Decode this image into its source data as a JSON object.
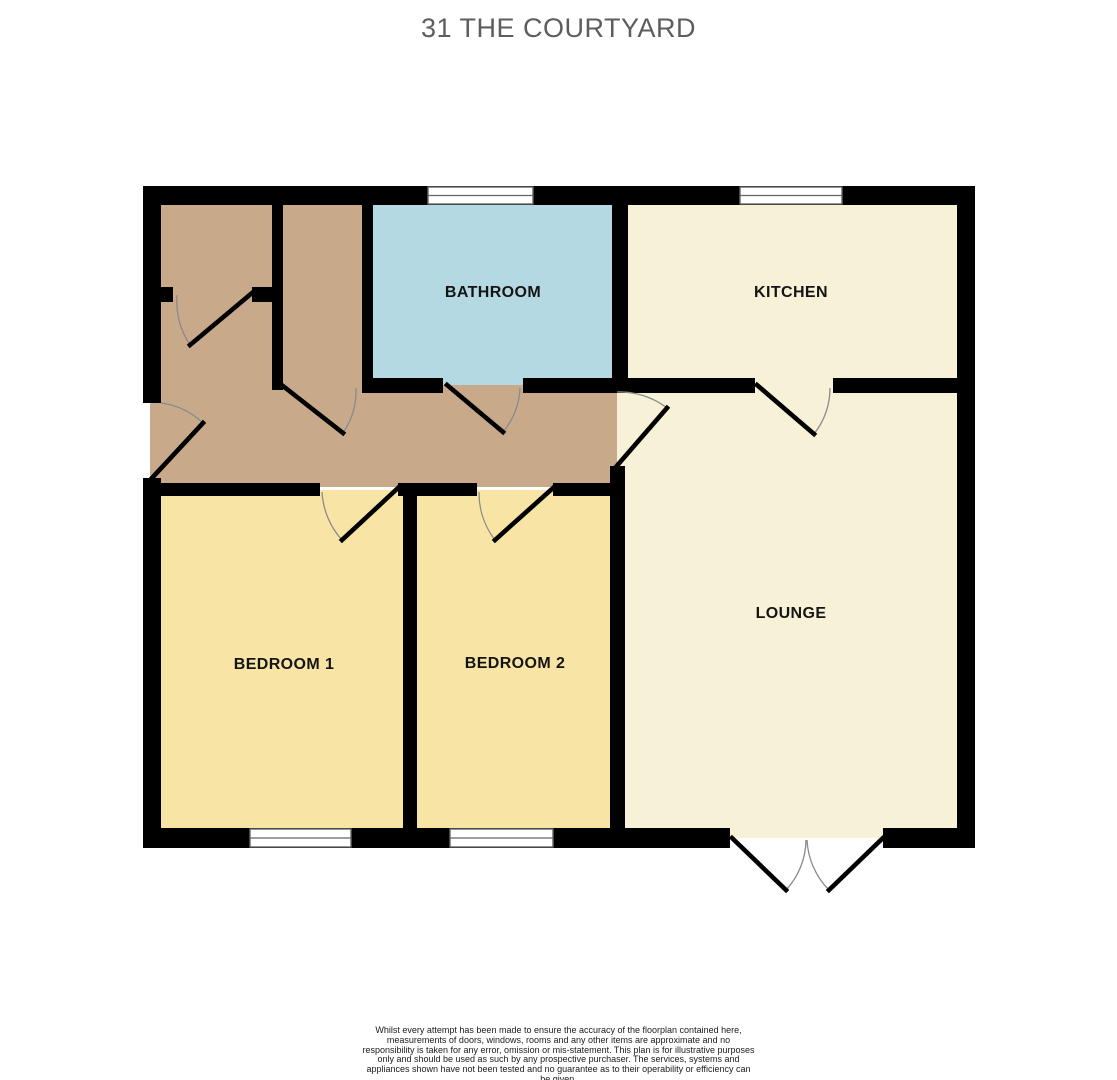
{
  "title": "31 THE COURTYARD",
  "floorplan": {
    "rooms": [
      {
        "id": "bathroom",
        "label": "BATHROOM",
        "color": "#b5d9e2"
      },
      {
        "id": "kitchen",
        "label": "KITCHEN",
        "color": "#f7f1d8"
      },
      {
        "id": "lounge",
        "label": "LOUNGE",
        "color": "#f7f1d8"
      },
      {
        "id": "bedroom-1",
        "label": "BEDROOM 1",
        "color": "#f8e5a5"
      },
      {
        "id": "bedroom-2",
        "label": "BEDROOM 2",
        "color": "#c8aa8a"
      },
      {
        "id": "hallway",
        "label": "",
        "color": "#c8aa8a"
      }
    ],
    "bedroom_color": "#f8e5a5",
    "wall_color": "#000000",
    "door_arc_color": "#8a8a8a"
  },
  "footer": {
    "disclaimer": "Whilst every attempt has been made to ensure the accuracy of the floorplan contained here, measurements of doors, windows, rooms and any other items are approximate and no responsibility is taken for any error, omission or mis-statement. This plan is for illustrative purposes only and should be used as such by any prospective purchaser. The services, systems and appliances shown have not been tested and no guarantee as to their operability or efficiency can be given.",
    "credit": "Made with Metropix ©2026"
  }
}
